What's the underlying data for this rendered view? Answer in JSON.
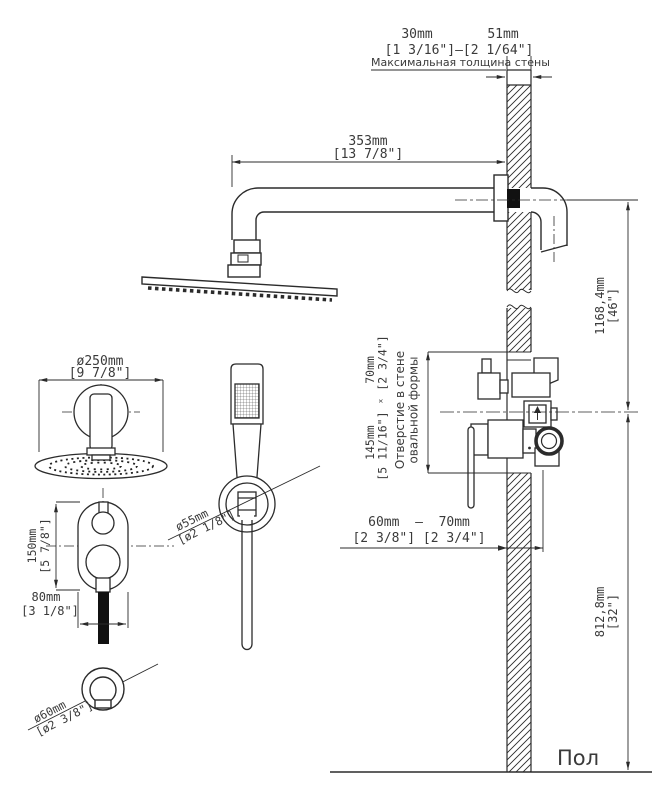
{
  "labels": {
    "max_wall_note": "Максимальная толщина стены",
    "hole_note_1": "Отверстие в стене",
    "hole_note_2": "овальной формы",
    "floor": "Пол"
  },
  "dims": {
    "wall_min": "30mm",
    "wall_max": "51mm",
    "wall_range_in": "[1 3/16\"]—[2 1/64\"]",
    "arm": "353mm",
    "arm_in": "[13 7/8\"]",
    "head": "ø250mm",
    "head_in": "[9 7/8\"]",
    "plate_h": "150mm",
    "plate_h_in": "[5 7/8\"]",
    "plate_w": "80mm",
    "plate_w_in": "[3 1/8\"]",
    "holder": "ø55mm",
    "holder_in": "[ø2 1/8\"]",
    "outlet": "ø60mm",
    "outlet_in": "[ø2 3/8\"]",
    "upper": "1168,4mm",
    "upper_in": "[46\"]",
    "lower": "812,8mm",
    "lower_in": "[32\"]",
    "hole_mm": "145mm      70mm",
    "hole_in": "[5 11/16\"] ˣ [2 3/4\"]",
    "depth_mm": "60mm  —  70mm",
    "depth_in": "[2 3/8\"] [2 3/4\"]"
  },
  "colors": {
    "line": "#2b2b2b",
    "text": "#3a3a3a",
    "solid": "#111111"
  }
}
